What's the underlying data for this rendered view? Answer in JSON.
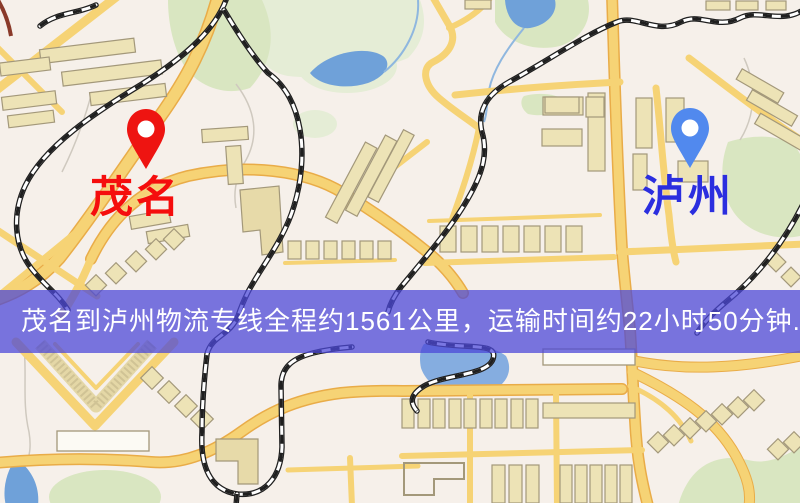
{
  "origin": {
    "label": "茂名"
  },
  "destination": {
    "label": "泸州"
  },
  "banner": {
    "text": "茂名到泸州物流专线全程约1561公里，运输时间约22小时50分钟."
  },
  "theme": {
    "base": "#F6F0EA",
    "originPin": "#EE1411",
    "originText": "#F50D0D",
    "destPin": "#5189EE",
    "destText": "#2B2EDF",
    "bannerBg": "#4C48D8",
    "bannerText": "#FFFFFF",
    "road": "#F6D375",
    "roadEdge": "#E9AC48",
    "water": "#6FA1D9",
    "water2": "#85ADE0",
    "park": "#D9E6C1",
    "park2": "#E5EDD6",
    "building": "#EDE3B6",
    "buildingEdge": "#A3987A",
    "railDark": "#1F1F1F"
  }
}
